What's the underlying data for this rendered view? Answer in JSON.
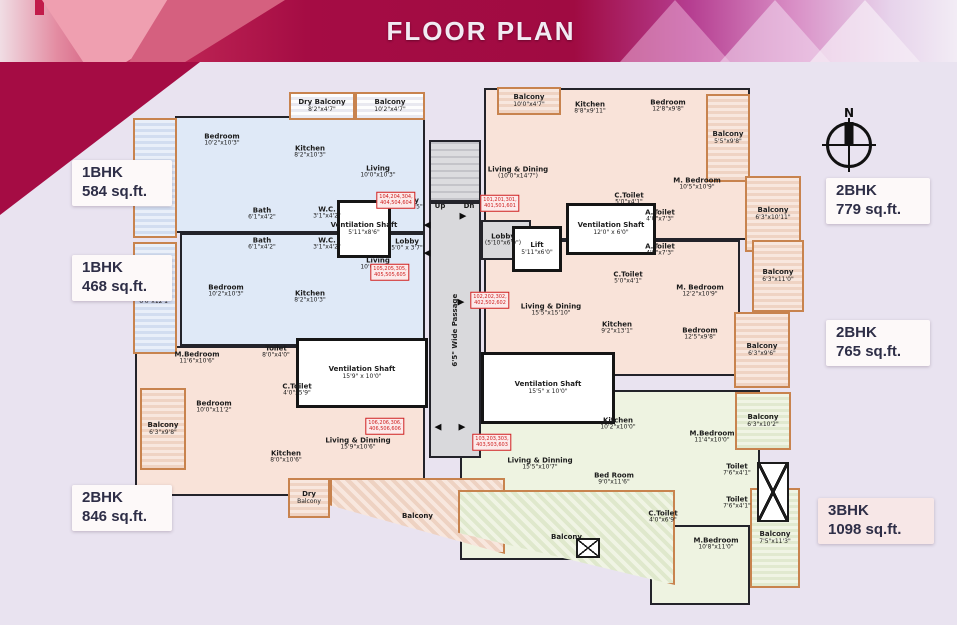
{
  "title": "FLOOR PLAN",
  "compass": {
    "label": "N"
  },
  "colors": {
    "banner_crimson": "#a50c44",
    "page_bg": "#e9e3f0",
    "unit_blue": "#dfe9f7",
    "unit_pink": "#f9e3d9",
    "unit_green": "#eef3e1",
    "balcony_border": "#c8834e",
    "wall": "#23232a",
    "flat_number_red": "#cf2020",
    "badge_text": "#2e2e47"
  },
  "unit_badges": [
    {
      "name": "1BHK",
      "area": "584 sq.ft.",
      "x": 72,
      "y": 160,
      "w": 100,
      "h": 46,
      "pinkish": false
    },
    {
      "name": "1BHK",
      "area": "468 sq.ft.",
      "x": 72,
      "y": 255,
      "w": 100,
      "h": 46,
      "pinkish": false
    },
    {
      "name": "2BHK",
      "area": "846 sq.ft.",
      "x": 72,
      "y": 485,
      "w": 100,
      "h": 46,
      "pinkish": false
    },
    {
      "name": "2BHK",
      "area": "779 sq.ft.",
      "x": 826,
      "y": 178,
      "w": 104,
      "h": 46,
      "pinkish": false
    },
    {
      "name": "2BHK",
      "area": "765 sq.ft.",
      "x": 826,
      "y": 320,
      "w": 104,
      "h": 46,
      "pinkish": false
    },
    {
      "name": "3BHK",
      "area": "1098 sq.ft.",
      "x": 818,
      "y": 498,
      "w": 116,
      "h": 46,
      "pinkish": true
    }
  ],
  "areas": [
    {
      "kind": "u-blue",
      "name": "unit-1bhk-584",
      "x": 175,
      "y": 116,
      "w": 250,
      "h": 117
    },
    {
      "kind": "u-blue",
      "name": "unit-1bhk-468",
      "x": 180,
      "y": 233,
      "w": 245,
      "h": 113
    },
    {
      "kind": "u-pink",
      "name": "unit-2bhk-779",
      "x": 484,
      "y": 88,
      "w": 266,
      "h": 152
    },
    {
      "kind": "u-pink",
      "name": "unit-2bhk-765",
      "x": 484,
      "y": 240,
      "w": 256,
      "h": 136
    },
    {
      "kind": "u-pink",
      "name": "unit-2bhk-846",
      "x": 135,
      "y": 346,
      "w": 290,
      "h": 150
    },
    {
      "kind": "u-green",
      "name": "unit-3bhk",
      "x": 460,
      "y": 390,
      "w": 300,
      "h": 170
    },
    {
      "kind": "u-green",
      "name": "unit-3bhk-mbedroom2",
      "x": 650,
      "y": 525,
      "w": 100,
      "h": 80
    },
    {
      "kind": "stairs",
      "name": "staircase",
      "x": 429,
      "y": 140,
      "w": 52,
      "h": 62
    },
    {
      "kind": "gray",
      "name": "passage",
      "x": 429,
      "y": 202,
      "w": 52,
      "h": 256,
      "label": "6'5\" Wide Passage",
      "rot": true
    },
    {
      "kind": "gray",
      "name": "lobby-gray",
      "x": 481,
      "y": 220,
      "w": 50,
      "h": 40
    },
    {
      "kind": "white",
      "name": "vent-shaft-1",
      "x": 337,
      "y": 200,
      "w": 54,
      "h": 58,
      "label": "Ventilation Shaft",
      "dims": "5'11\"x8'6\""
    },
    {
      "kind": "white",
      "name": "vent-shaft-2",
      "x": 566,
      "y": 203,
      "w": 90,
      "h": 52,
      "label": "Ventilation Shaft",
      "dims": "12'0\" x 6'0\""
    },
    {
      "kind": "white",
      "name": "vent-shaft-3",
      "x": 296,
      "y": 338,
      "w": 132,
      "h": 70,
      "label": "Ventilation Shaft",
      "dims": "15'9\" x 10'0\""
    },
    {
      "kind": "white",
      "name": "vent-shaft-4",
      "x": 481,
      "y": 352,
      "w": 134,
      "h": 72,
      "label": "Ventilation Shaft",
      "dims": "15'5\" x 10'0\""
    },
    {
      "kind": "white",
      "name": "lift",
      "x": 512,
      "y": 226,
      "w": 50,
      "h": 46,
      "label": "Lift",
      "dims": "5'11\"x6'0\""
    },
    {
      "kind": "b-blue",
      "name": "balcony",
      "x": 133,
      "y": 118,
      "w": 44,
      "h": 120,
      "label": "Balcony",
      "dims": "6'0\"x15'0\""
    },
    {
      "kind": "b-blue",
      "name": "balcony",
      "x": 133,
      "y": 242,
      "w": 44,
      "h": 112,
      "label": "Balcony",
      "dims": "6'0\"x12'1\""
    },
    {
      "kind": "b-plain",
      "name": "dry-balcony",
      "x": 289,
      "y": 92,
      "w": 66,
      "h": 28,
      "label": "Dry Balcony",
      "dims": "8'2\"x4'7\""
    },
    {
      "kind": "b-plain",
      "name": "balcony",
      "x": 355,
      "y": 92,
      "w": 70,
      "h": 28,
      "label": "Balcony",
      "dims": "10'2\"x4'7\""
    },
    {
      "kind": "b-pink",
      "name": "balcony",
      "x": 497,
      "y": 87,
      "w": 64,
      "h": 28,
      "label": "Balcony",
      "dims": "10'0\"x4'7\""
    },
    {
      "kind": "b-pink",
      "name": "balcony",
      "x": 706,
      "y": 94,
      "w": 44,
      "h": 88,
      "label": "Balcony",
      "dims": "5'5\"x9'8\""
    },
    {
      "kind": "b-pink",
      "name": "balcony",
      "x": 745,
      "y": 176,
      "w": 56,
      "h": 76,
      "label": "Balcony",
      "dims": "6'3\"x10'11\""
    },
    {
      "kind": "b-pink",
      "name": "balcony",
      "x": 752,
      "y": 240,
      "w": 52,
      "h": 72,
      "label": "Balcony",
      "dims": "6'3\"x11'0\""
    },
    {
      "kind": "b-pink",
      "name": "balcony",
      "x": 734,
      "y": 312,
      "w": 56,
      "h": 76,
      "label": "Balcony",
      "dims": "6'3\"x9'6\""
    },
    {
      "kind": "b-pink",
      "name": "balcony",
      "x": 140,
      "y": 388,
      "w": 46,
      "h": 82,
      "label": "Balcony",
      "dims": "6'3\"x9'8\""
    },
    {
      "kind": "b-pink",
      "name": "dry-balcony",
      "x": 288,
      "y": 478,
      "w": 42,
      "h": 40,
      "label": "Dry",
      "dims": "Balcony"
    },
    {
      "kind": "b-diag-pink",
      "name": "balcony-large-left",
      "x": 330,
      "y": 478,
      "w": 175,
      "h": 76,
      "label": "Balcony",
      "clip": "polygon(0 0,100% 0,100% 100%,0 36%)"
    },
    {
      "kind": "b-diag-green",
      "name": "balcony-large-3bhk",
      "x": 458,
      "y": 490,
      "w": 217,
      "h": 95,
      "label": "Balcony",
      "clip": "polygon(0 0,100% 0,100% 100%,0 45%)"
    },
    {
      "kind": "b-green",
      "name": "balcony",
      "x": 735,
      "y": 392,
      "w": 56,
      "h": 58,
      "label": "Balcony",
      "dims": "6'3\"x10'2\""
    },
    {
      "kind": "b-green",
      "name": "balcony",
      "x": 750,
      "y": 488,
      "w": 50,
      "h": 100,
      "label": "Balcony",
      "dims": "7'5\"x11'3\""
    }
  ],
  "rooms": [
    {
      "label": "Bedroom",
      "dims": "10'2\"x10'3\"",
      "x": 222,
      "y": 140
    },
    {
      "label": "Kitchen",
      "dims": "8'2\"x10'3\"",
      "x": 310,
      "y": 152
    },
    {
      "label": "Living",
      "dims": "10'0\"x10'3\"",
      "x": 378,
      "y": 172
    },
    {
      "label": "Bath",
      "dims": "6'1\"x4'2\"",
      "x": 262,
      "y": 214
    },
    {
      "label": "W.C.",
      "dims": "3'1\"x4'2\"",
      "x": 327,
      "y": 213
    },
    {
      "label": "Lobby",
      "dims": "5'5\" x 5'5\"",
      "x": 407,
      "y": 204
    },
    {
      "label": "Lobby",
      "dims": "5'0\" x 3'7\"",
      "x": 407,
      "y": 245
    },
    {
      "label": "Bath",
      "dims": "6'1\"x4'2\"",
      "x": 262,
      "y": 244
    },
    {
      "label": "W.C.",
      "dims": "3'1\"x4'2\"",
      "x": 327,
      "y": 244
    },
    {
      "label": "Bedroom",
      "dims": "10'2\"x10'3\"",
      "x": 226,
      "y": 291
    },
    {
      "label": "Kitchen",
      "dims": "8'2\"x10'3\"",
      "x": 310,
      "y": 297
    },
    {
      "label": "Living",
      "dims": "10'0\"x10'3\"",
      "x": 378,
      "y": 264
    },
    {
      "label": "Living & Dining",
      "dims": "(10'0\"x14'7\")",
      "x": 518,
      "y": 173
    },
    {
      "label": "Kitchen",
      "dims": "8'8\"x9'11\"",
      "x": 590,
      "y": 108
    },
    {
      "label": "Bedroom",
      "dims": "12'8\"x9'8\"",
      "x": 668,
      "y": 106
    },
    {
      "label": "C.Toilet",
      "dims": "5'0\"x4'1\"",
      "x": 629,
      "y": 199
    },
    {
      "label": "A.Toilet",
      "dims": "4'0\"x7'3\"",
      "x": 660,
      "y": 216
    },
    {
      "label": "M. Bedroom",
      "dims": "10'5\"x10'9\"",
      "x": 697,
      "y": 184
    },
    {
      "label": "A.Toilet",
      "dims": "4'0\"x7'3\"",
      "x": 660,
      "y": 250
    },
    {
      "label": "C.Toilet",
      "dims": "5'0\"x4'1\"",
      "x": 628,
      "y": 278
    },
    {
      "label": "M. Bedroom",
      "dims": "12'2\"x10'9\"",
      "x": 700,
      "y": 291
    },
    {
      "label": "Living & Dining",
      "dims": "15'5\"x15'10\"",
      "x": 551,
      "y": 310
    },
    {
      "label": "Kitchen",
      "dims": "9'2\"x13'1\"",
      "x": 617,
      "y": 328
    },
    {
      "label": "Bedroom",
      "dims": "12'5\"x9'8\"",
      "x": 700,
      "y": 334
    },
    {
      "label": "Lobby",
      "dims": "(5'10\"x6'0\")",
      "x": 503,
      "y": 240
    },
    {
      "label": "Up",
      "dims": "",
      "x": 440,
      "y": 206
    },
    {
      "label": "Dn",
      "dims": "",
      "x": 469,
      "y": 206
    },
    {
      "label": "M.Bedroom",
      "dims": "11'6\"x10'6\"",
      "x": 197,
      "y": 358
    },
    {
      "label": "Toilet",
      "dims": "8'0\"x4'0\"",
      "x": 276,
      "y": 352
    },
    {
      "label": "C.Toilet",
      "dims": "4'0\"x5'9\"",
      "x": 297,
      "y": 390
    },
    {
      "label": "Bedroom",
      "dims": "10'0\"x11'2\"",
      "x": 214,
      "y": 407
    },
    {
      "label": "Kitchen",
      "dims": "8'0\"x10'6\"",
      "x": 286,
      "y": 457
    },
    {
      "label": "Living & Dinning",
      "dims": "15'9\"x10'6\"",
      "x": 358,
      "y": 444
    },
    {
      "label": "Kitchen",
      "dims": "10'2\"x10'0\"",
      "x": 618,
      "y": 424
    },
    {
      "label": "Living & Dinning",
      "dims": "15'5\"x10'7\"",
      "x": 540,
      "y": 464
    },
    {
      "label": "Bed Room",
      "dims": "9'0\"x11'6\"",
      "x": 614,
      "y": 479
    },
    {
      "label": "M.Bedroom",
      "dims": "11'4\"x10'0\"",
      "x": 712,
      "y": 437
    },
    {
      "label": "Toilet",
      "dims": "7'6\"x4'1\"",
      "x": 737,
      "y": 470
    },
    {
      "label": "Toilet",
      "dims": "7'6\"x4'1\"",
      "x": 737,
      "y": 503
    },
    {
      "label": "C.Toilet",
      "dims": "4'0\"x6'9\"",
      "x": 663,
      "y": 517
    },
    {
      "label": "M.Bedroom",
      "dims": "10'8\"x11'0\"",
      "x": 716,
      "y": 544
    }
  ],
  "flat_number_boxes": [
    {
      "line1": "104,204,304,",
      "line2": "404,504,604",
      "x": 396,
      "y": 200
    },
    {
      "line1": "101,201,301,",
      "line2": "401,501,601",
      "x": 500,
      "y": 203
    },
    {
      "line1": "105,205,305,",
      "line2": "405,505,605",
      "x": 390,
      "y": 272
    },
    {
      "line1": "102,202,302,",
      "line2": "402,502,602",
      "x": 490,
      "y": 300
    },
    {
      "line1": "106,206,306,",
      "line2": "406,506,606",
      "x": 385,
      "y": 426
    },
    {
      "line1": "103,203,303,",
      "line2": "403,503,603",
      "x": 492,
      "y": 442
    }
  ],
  "arrows": [
    {
      "glyph": "◀",
      "x": 427,
      "y": 226
    },
    {
      "glyph": "◀",
      "x": 427,
      "y": 254
    },
    {
      "glyph": "▶",
      "x": 463,
      "y": 217
    },
    {
      "glyph": "▶",
      "x": 461,
      "y": 303
    },
    {
      "glyph": "◀",
      "x": 438,
      "y": 428
    },
    {
      "glyph": "▶",
      "x": 462,
      "y": 428
    }
  ],
  "duct_boxes": [
    {
      "x": 757,
      "y": 462,
      "w": 32,
      "h": 60
    },
    {
      "x": 576,
      "y": 538,
      "w": 24,
      "h": 20
    }
  ]
}
